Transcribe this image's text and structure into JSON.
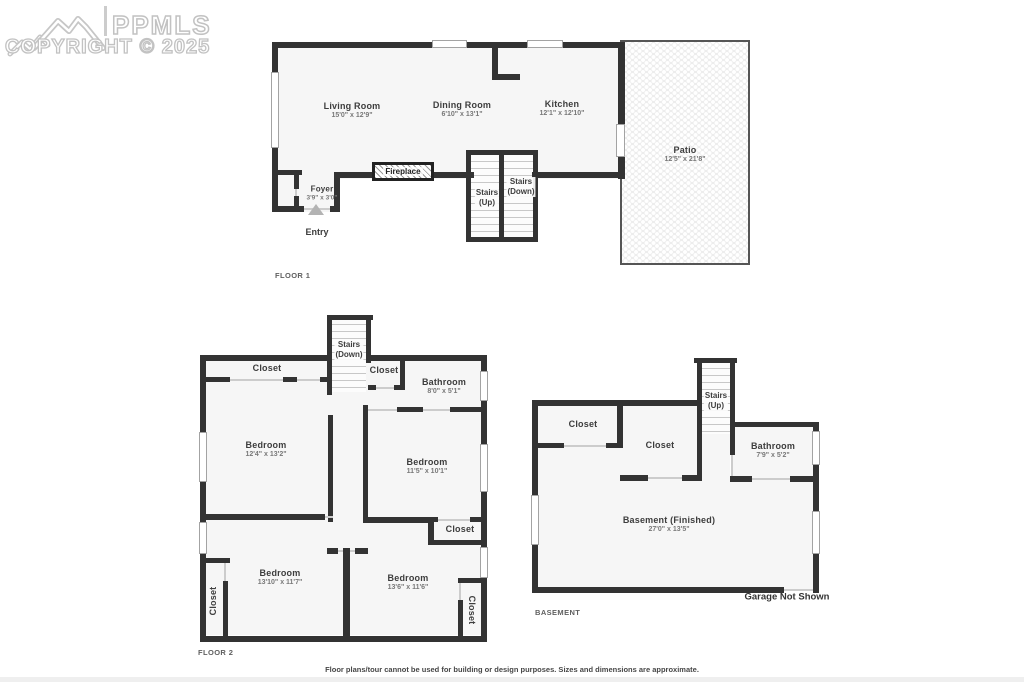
{
  "watermark": {
    "brand": "PPMLS",
    "copyright": "COPYRIGHT © 2025"
  },
  "floor1": {
    "section_label": "FLOOR 1",
    "living": {
      "name": "Living Room",
      "dims": "15'0\" x 12'9\""
    },
    "dining": {
      "name": "Dining Room",
      "dims": "6'10\" x 13'1\""
    },
    "kitchen": {
      "name": "Kitchen",
      "dims": "12'1\" x 12'10\""
    },
    "patio": {
      "name": "Patio",
      "dims": "12'5\" x 21'8\""
    },
    "foyer": {
      "name": "Foyer",
      "dims": "3'9\" x 3'0\""
    },
    "fireplace": "Fireplace",
    "entry": "Entry",
    "stairs_up": {
      "line1": "Stairs",
      "line2": "(Up)"
    },
    "stairs_down": {
      "line1": "Stairs",
      "line2": "(Down)"
    }
  },
  "floor2": {
    "section_label": "FLOOR 2",
    "stairs_down": {
      "line1": "Stairs",
      "line2": "(Down)"
    },
    "closet_top_left": "Closet",
    "closet_mid": "Closet",
    "bathroom": {
      "name": "Bathroom",
      "dims": "8'0\" x 5'1\""
    },
    "bedroom_left": {
      "name": "Bedroom",
      "dims": "12'4\" x 13'2\""
    },
    "bedroom_right": {
      "name": "Bedroom",
      "dims": "11'5\" x 10'1\""
    },
    "closet_right": "Closet",
    "bedroom_bottom_left": {
      "name": "Bedroom",
      "dims": "13'10\" x 11'7\""
    },
    "bedroom_bottom_right": {
      "name": "Bedroom",
      "dims": "13'6\" x 11'6\""
    },
    "closet_bottom_left": "Closet",
    "closet_bottom_right": "Closet"
  },
  "basement": {
    "section_label": "BASEMENT",
    "stairs_up": {
      "line1": "Stairs",
      "line2": "(Up)"
    },
    "closet_left": "Closet",
    "closet_mid": "Closet",
    "bathroom": {
      "name": "Bathroom",
      "dims": "7'9\" x 5'2\""
    },
    "main": {
      "name": "Basement (Finished)",
      "dims": "27'0\" x 13'5\""
    },
    "garage_note": "Garage Not Shown"
  },
  "footer": {
    "disclaimer": "Floor plans/tour cannot be used for building or design purposes. Sizes and dimensions are approximate."
  }
}
